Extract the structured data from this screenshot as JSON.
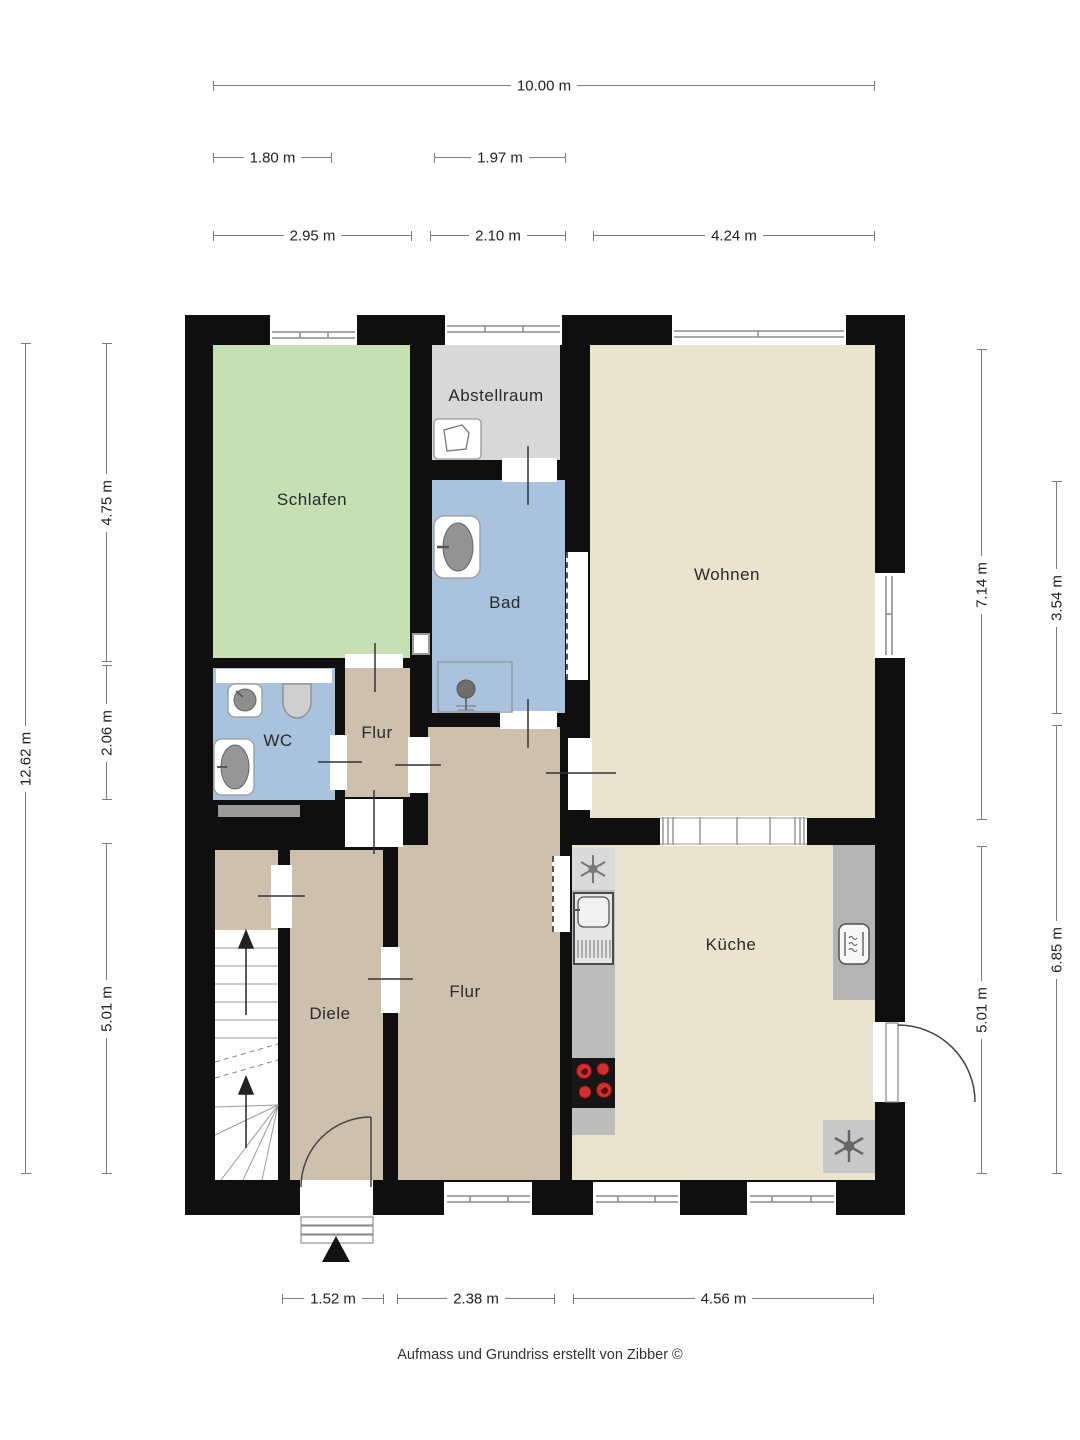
{
  "plan": {
    "rooms": {
      "schlafen": "Schlafen",
      "abstellraum": "Abstellraum",
      "bad": "Bad",
      "wohnen": "Wohnen",
      "wc": "WC",
      "flur_small": "Flur",
      "flur_main": "Flur",
      "diele": "Diele",
      "kueche": "Küche"
    },
    "fixtures": [
      "fan-icon",
      "sink-icon",
      "stove-icon",
      "oven-icon",
      "shower-icon",
      "toilet-icon",
      "washbasin-icon",
      "stairs",
      "north-arrow-icon",
      "radiator",
      "entrance-door",
      "exterior-door"
    ]
  },
  "dims": {
    "top_total": "10.00 m",
    "top_a": "1.80 m",
    "top_b": "1.97 m",
    "top_c": "2.95 m",
    "top_d": "2.10 m",
    "top_e": "4.24 m",
    "left_total": "12.62 m",
    "left_a": "4.75 m",
    "left_b": "2.06 m",
    "left_c": "5.01 m",
    "right_a": "7.14 m",
    "right_b": "5.01 m",
    "right_c": "3.54 m",
    "right_d": "6.85 m",
    "bottom_a": "1.52 m",
    "bottom_b": "2.38 m",
    "bottom_c": "4.56 m"
  },
  "footer": "Aufmass und Grundriss erstellt von Zibber ©",
  "colors": {
    "wall": "#0f0f0f",
    "living_beige": "#eae3cd",
    "sleeping_green": "#c6dfb3",
    "wet_blue": "#a9c2de",
    "hall_tan": "#cdc0ad",
    "storage_gray": "#d8d8d8",
    "counter_gray": "#bcbcbc",
    "burner_red": "#d32f2f",
    "dim_line_gray": "#7c7c7c"
  }
}
